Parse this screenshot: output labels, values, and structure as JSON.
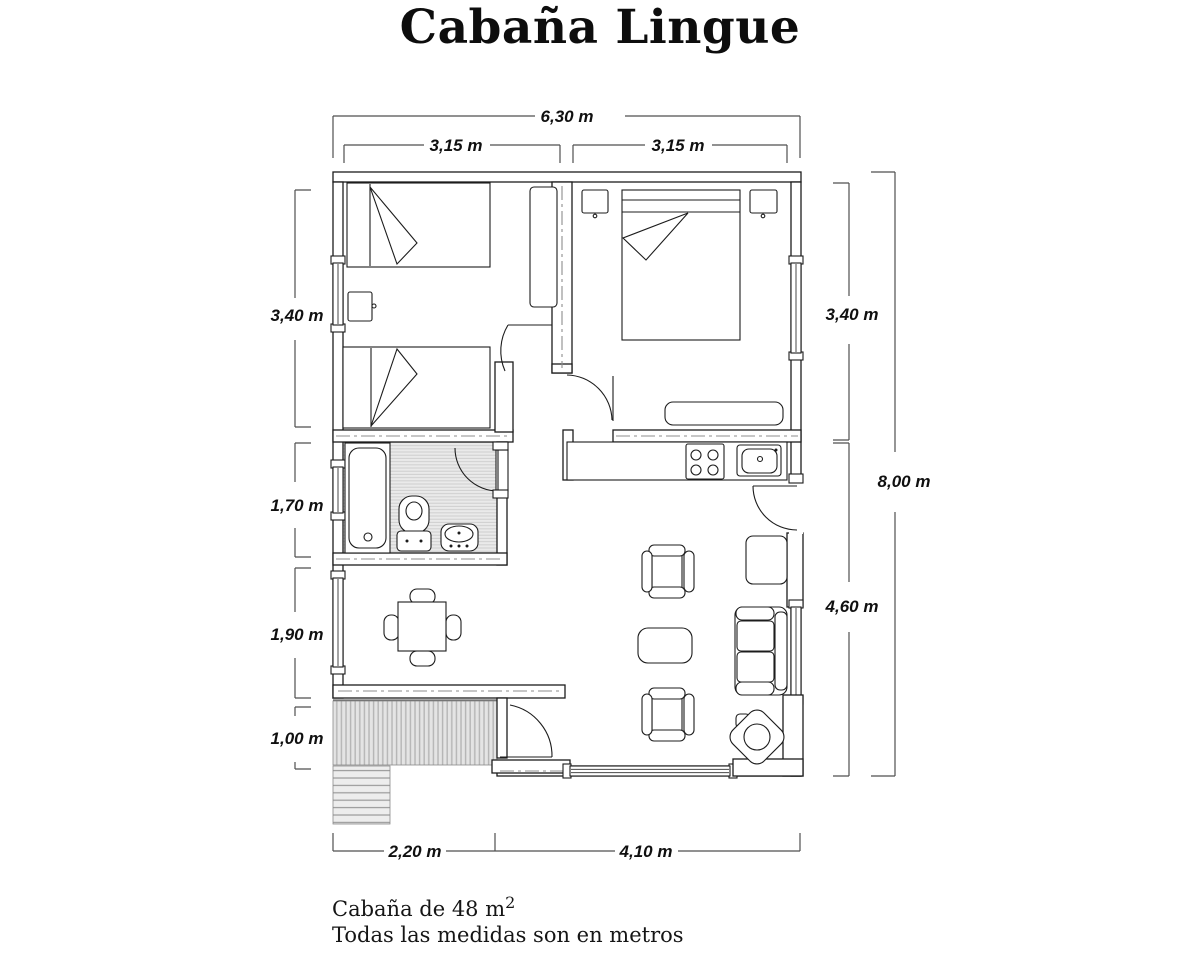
{
  "title": "Cabaña Lingue",
  "dimensions": {
    "top_total": "6,30 m",
    "top_left": "3,15 m",
    "top_right": "3,15 m",
    "left_bedroom": "3,40 m",
    "left_bathroom": "1,70 m",
    "left_dining": "1,90 m",
    "left_porch": "1,00 m",
    "right_bedroom": "3,40 m",
    "right_living": "4,60 m",
    "right_total": "8,00 m",
    "bottom_porch": "2,20 m",
    "bottom_living": "4,10 m"
  },
  "notes": {
    "area_text": "Cabaña de 48 m",
    "area_sup": "2",
    "units_text": "Todas las medidas son en metros"
  },
  "colors": {
    "line": "#1c1c1c",
    "dimension_line": "#4f4f4f",
    "centerline": "#8d8d8d",
    "hatch": "#bdbdbd"
  }
}
